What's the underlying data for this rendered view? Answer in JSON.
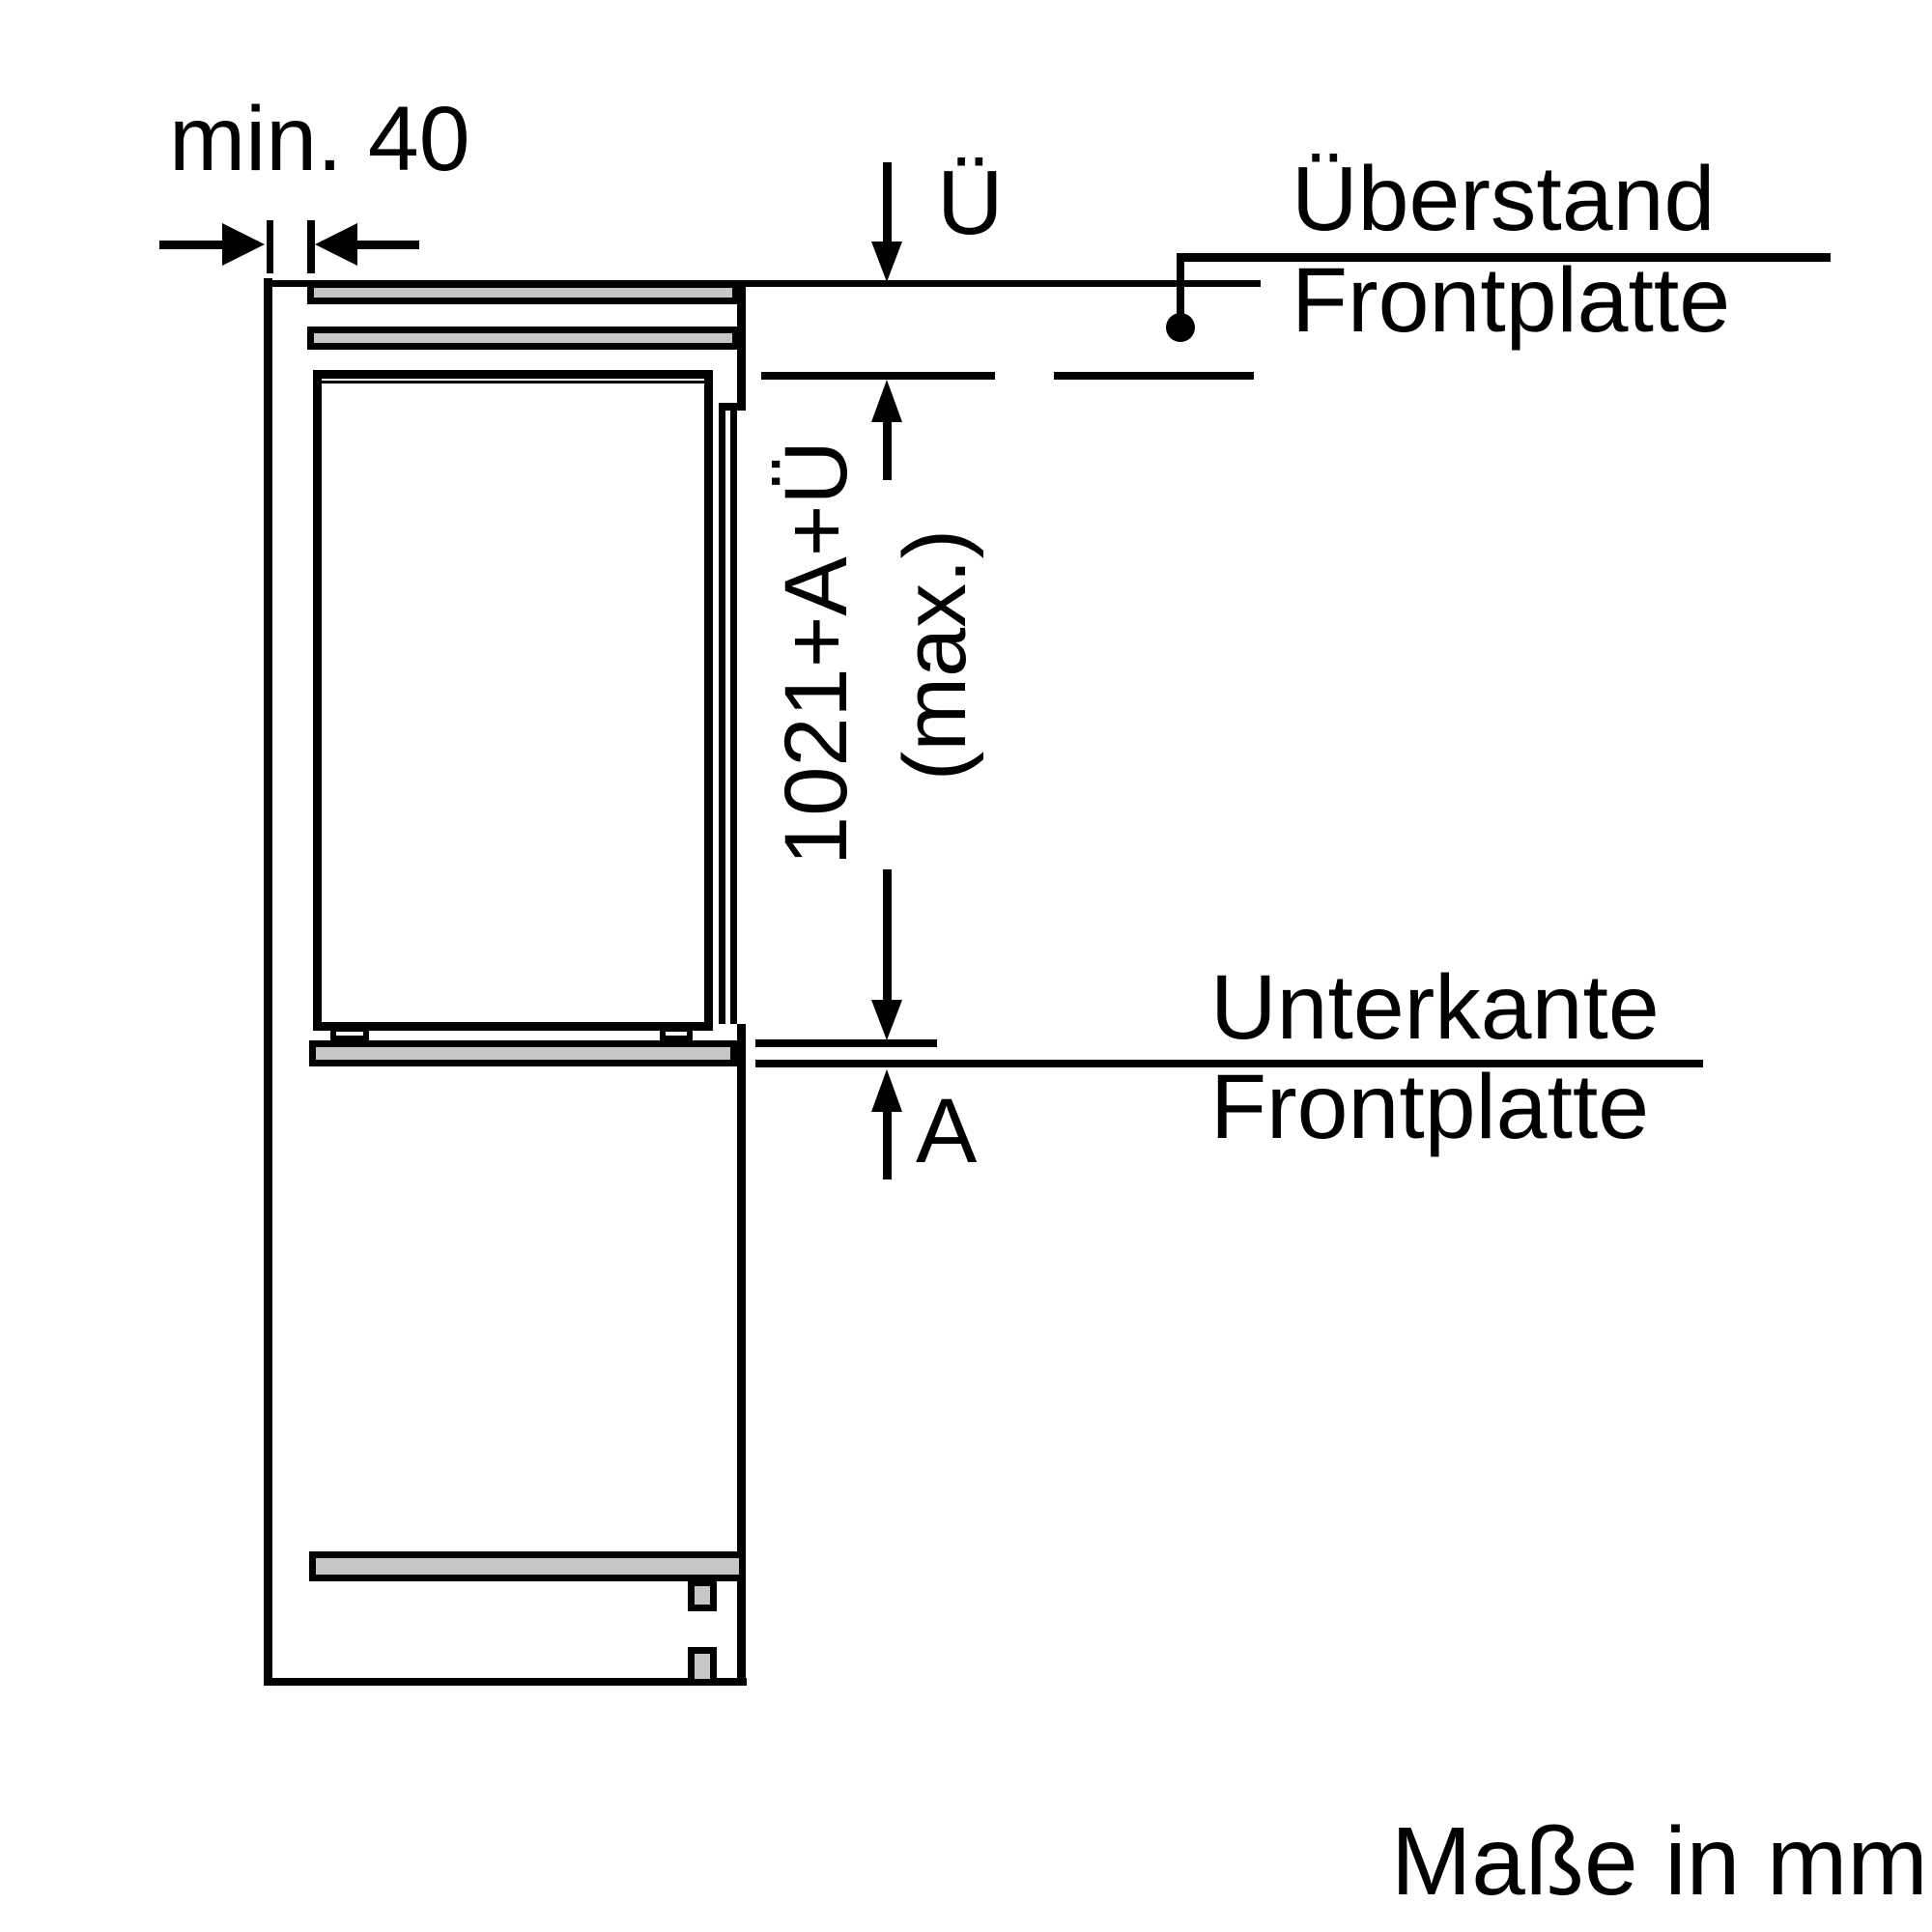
{
  "diagram": {
    "unit_note": "Maße in mm",
    "top_gap_label": "min. 40",
    "overhang": {
      "symbol": "Ü",
      "name_line1": "Überstand",
      "name_line2": "Frontplatte"
    },
    "panel_length": {
      "formula": "1021+A+Ü",
      "qualifier": "(max.)"
    },
    "bottom_gap": {
      "symbol": "A",
      "name_line1": "Unterkante",
      "name_line2": "Frontplatte"
    }
  },
  "colors": {
    "line": "#000000",
    "panel_fill": "#c6c6c6",
    "background": "#ffffff"
  }
}
